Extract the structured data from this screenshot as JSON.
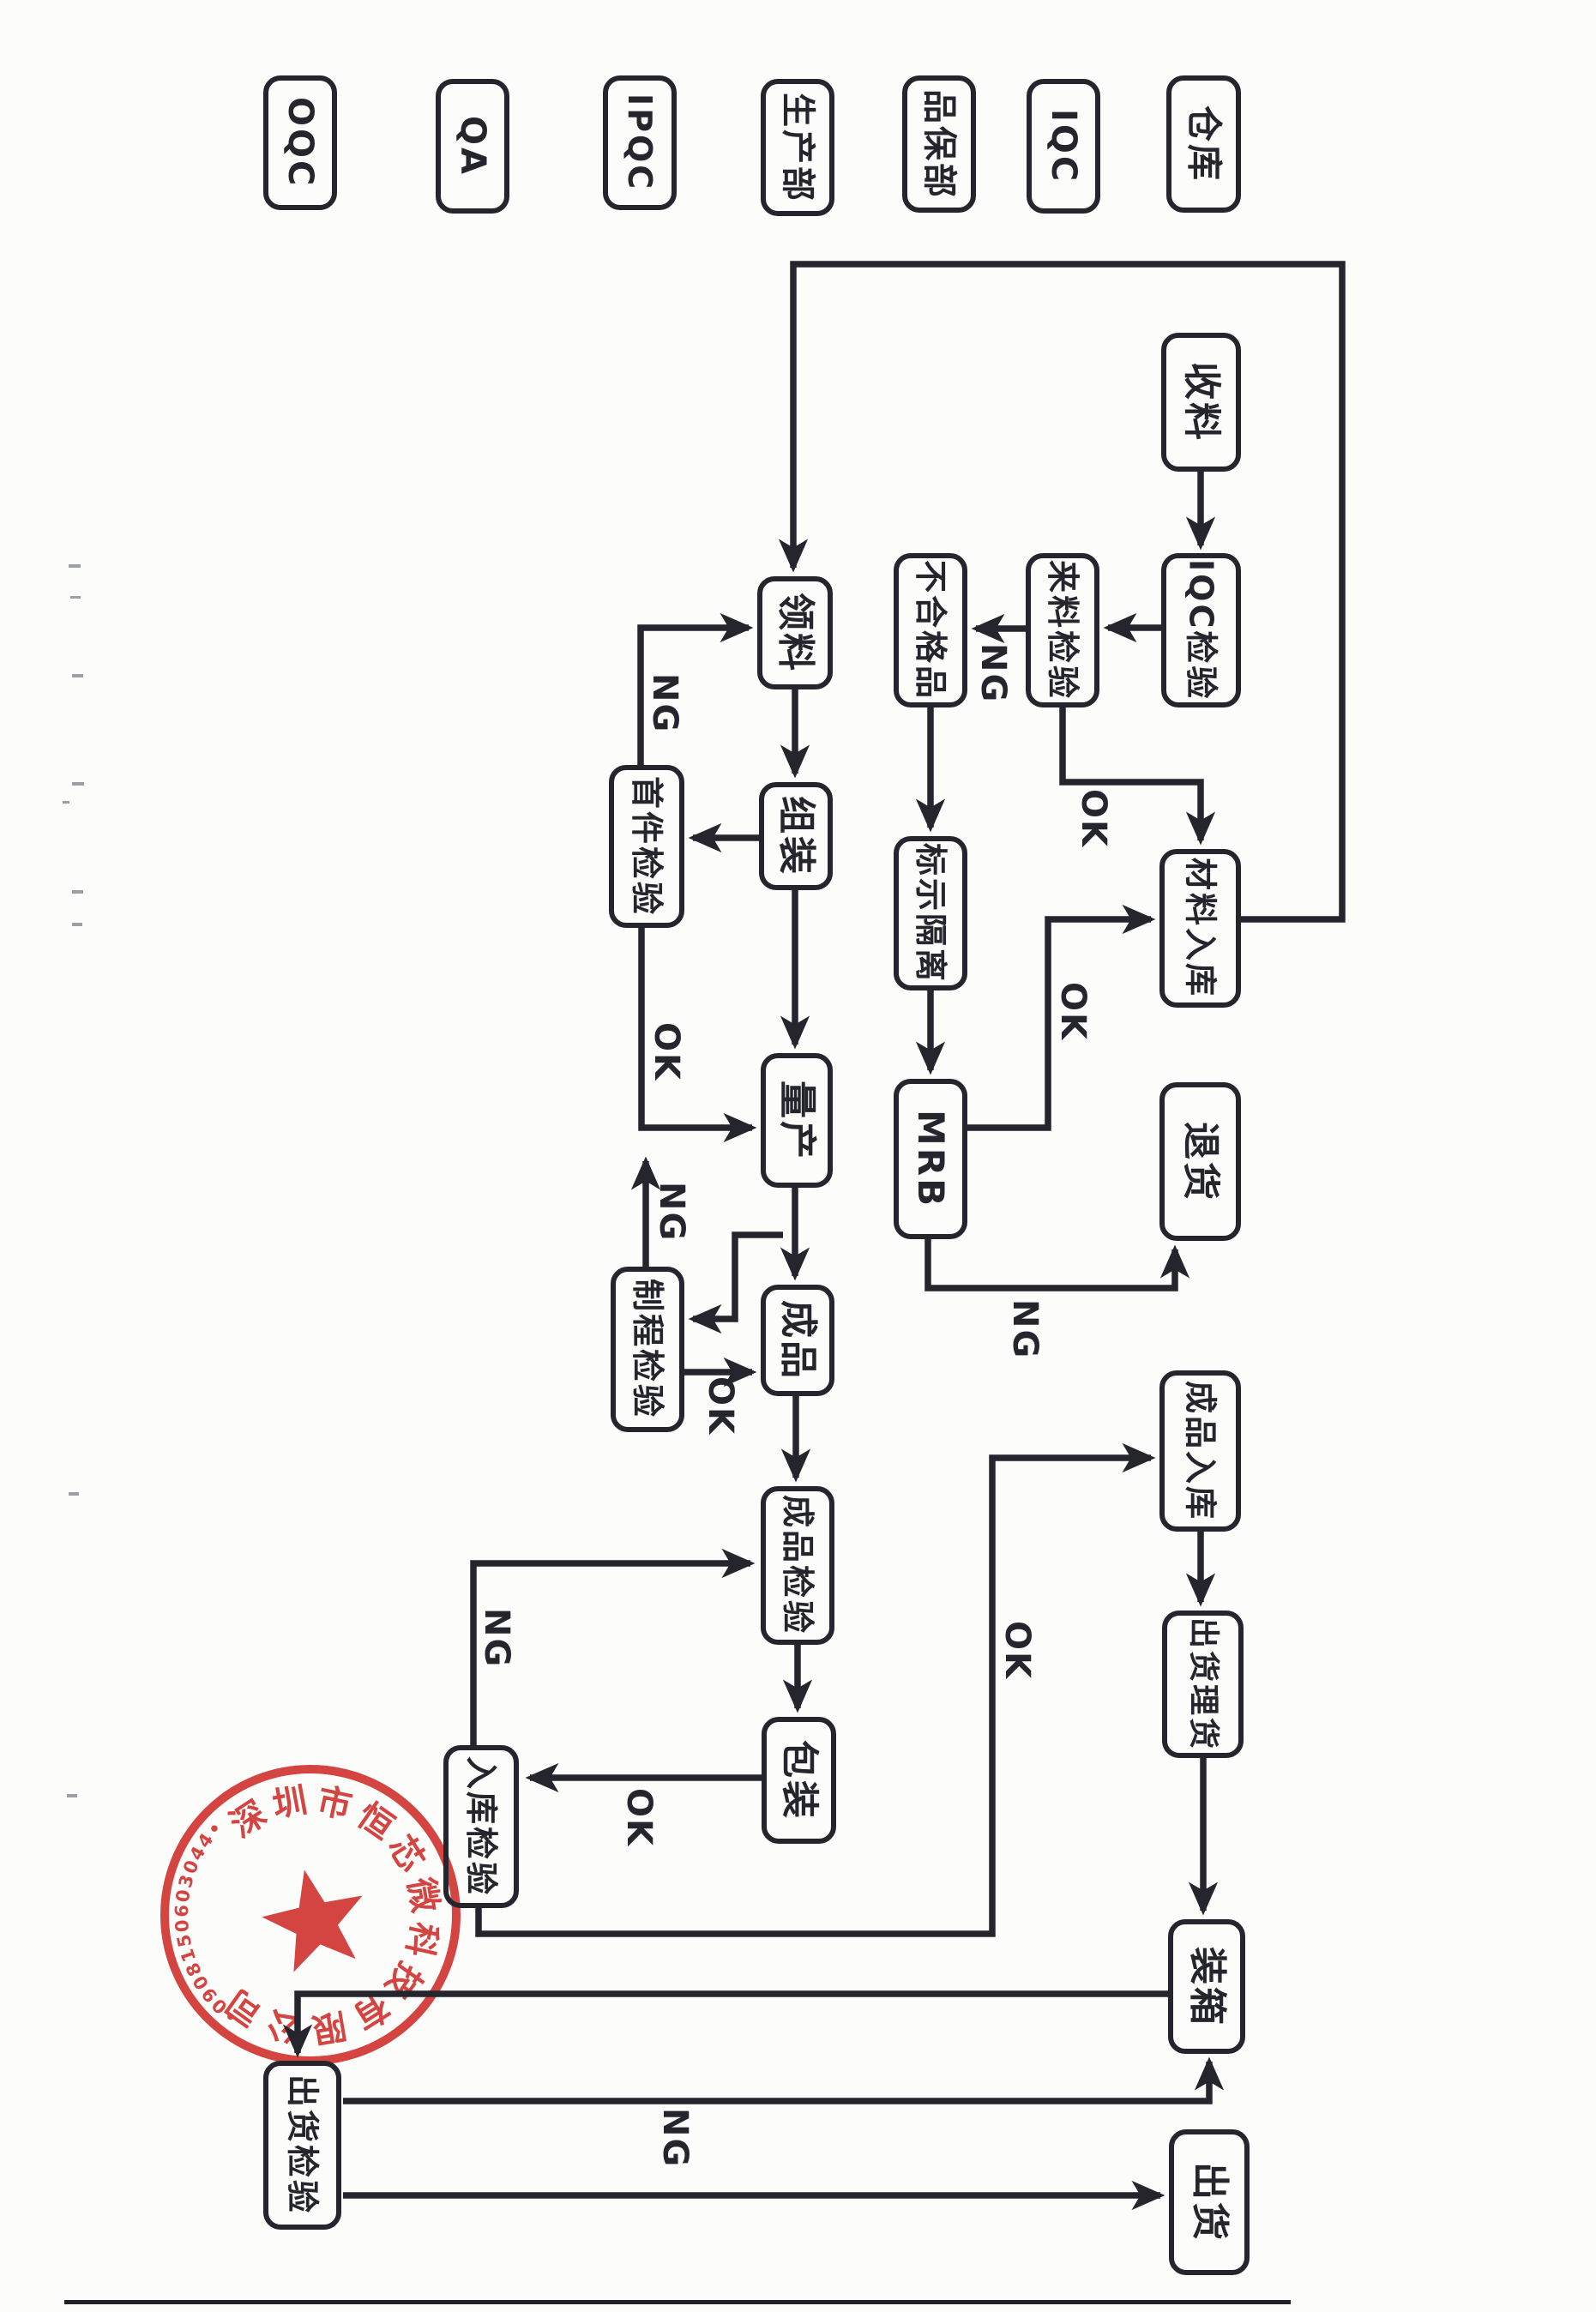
{
  "document": {
    "kind": "scanned quality-control process flowchart, rotated 90° clockwise on the page"
  },
  "lanes": [
    {
      "label": "OQC"
    },
    {
      "label": "QA"
    },
    {
      "label": "IPQC"
    },
    {
      "label": "生产部"
    },
    {
      "label": "品保部"
    },
    {
      "label": "IQC"
    },
    {
      "label": "仓库"
    }
  ],
  "nodes": {
    "receive_material": {
      "label": "收料",
      "lane": "仓库"
    },
    "iqc_check": {
      "label": "IQC检验",
      "lane": "仓库"
    },
    "incoming_inspection": {
      "label": "来料检验",
      "lane": "IQC"
    },
    "nonconforming_product": {
      "label": "不合格品",
      "lane": "品保部"
    },
    "mark_isolate": {
      "label": "标示隔离",
      "lane": "品保部"
    },
    "mrb": {
      "label": "MRB",
      "lane": "品保部"
    },
    "material_storage": {
      "label": "材料入库",
      "lane": "仓库"
    },
    "return_goods": {
      "label": "退货",
      "lane": "仓库"
    },
    "draw_material": {
      "label": "领料",
      "lane": "生产部"
    },
    "assembly": {
      "label": "组装",
      "lane": "生产部"
    },
    "first_article_inspection": {
      "label": "首件检验",
      "lane": "IPQC"
    },
    "mass_production": {
      "label": "量产",
      "lane": "生产部"
    },
    "in_process_inspection": {
      "label": "制程检验",
      "lane": "IPQC"
    },
    "finished_product": {
      "label": "成品",
      "lane": "生产部"
    },
    "finished_inspection": {
      "label": "成品检验",
      "lane": "生产部"
    },
    "packing": {
      "label": "包装",
      "lane": "生产部"
    },
    "warehousing_inspection": {
      "label": "入库检验",
      "lane": "QA"
    },
    "finished_goods_storage": {
      "label": "成品入库",
      "lane": "仓库"
    },
    "shipping_tally": {
      "label": "出货理货",
      "lane": "仓库"
    },
    "boxing": {
      "label": "装箱",
      "lane": "仓库"
    },
    "shipment_inspection": {
      "label": "出货检验",
      "lane": "OQC"
    },
    "shipping": {
      "label": "出货",
      "lane": "仓库"
    }
  },
  "edge_labels": {
    "incoming_ng": "NG",
    "incoming_ok": "OK",
    "mrb_ok": "OK",
    "mrb_ng": "NG",
    "first_article_ng": "NG",
    "first_article_ok": "OK",
    "in_process_ng": "NG",
    "in_process_ok": "OK",
    "packing_ok": "OK",
    "warehousing_ng": "NG",
    "warehousing_ok": "OK",
    "shipment_ng": "NG"
  },
  "flow": [
    {
      "from": "收料",
      "to": "IQC检验",
      "label": ""
    },
    {
      "from": "IQC检验",
      "to": "来料检验",
      "label": ""
    },
    {
      "from": "来料检验",
      "to": "不合格品",
      "label": "NG"
    },
    {
      "from": "来料检验",
      "to": "材料入库",
      "label": "OK"
    },
    {
      "from": "不合格品",
      "to": "标示隔离",
      "label": ""
    },
    {
      "from": "标示隔离",
      "to": "MRB",
      "label": ""
    },
    {
      "from": "MRB",
      "to": "材料入库",
      "label": "OK"
    },
    {
      "from": "MRB",
      "to": "退货",
      "label": "NG"
    },
    {
      "from": "材料入库",
      "to": "领料",
      "label": ""
    },
    {
      "from": "领料",
      "to": "组装",
      "label": ""
    },
    {
      "from": "组装",
      "to": "首件检验",
      "label": ""
    },
    {
      "from": "首件检验",
      "to": "领料",
      "label": "NG"
    },
    {
      "from": "首件检验",
      "to": "量产",
      "label": "OK"
    },
    {
      "from": "组装",
      "to": "量产",
      "label": ""
    },
    {
      "from": "量产",
      "to": "成品",
      "label": ""
    },
    {
      "from": "量产",
      "to": "制程检验",
      "label": ""
    },
    {
      "from": "制程检验",
      "to": "量产",
      "label": "NG"
    },
    {
      "from": "制程检验",
      "to": "成品",
      "label": "OK"
    },
    {
      "from": "成品",
      "to": "成品检验",
      "label": ""
    },
    {
      "from": "成品检验",
      "to": "包装",
      "label": ""
    },
    {
      "from": "包装",
      "to": "入库检验",
      "label": "OK"
    },
    {
      "from": "入库检验",
      "to": "成品检验",
      "label": "NG"
    },
    {
      "from": "入库检验",
      "to": "成品入库",
      "label": "OK"
    },
    {
      "from": "成品入库",
      "to": "出货理货",
      "label": ""
    },
    {
      "from": "出货理货",
      "to": "装箱",
      "label": ""
    },
    {
      "from": "装箱",
      "to": "出货检验",
      "label": ""
    },
    {
      "from": "出货检验",
      "to": "装箱",
      "label": "NG"
    },
    {
      "from": "出货检验",
      "to": "出货",
      "label": ""
    }
  ],
  "stamp": {
    "company": "深圳市恒芯微科技有限公司",
    "serial": "4403060518090",
    "color": "#d0312d"
  },
  "colors": {
    "ink": "#25252d",
    "paper": "#fcfcfb",
    "stamp_red": "#d0312d"
  }
}
